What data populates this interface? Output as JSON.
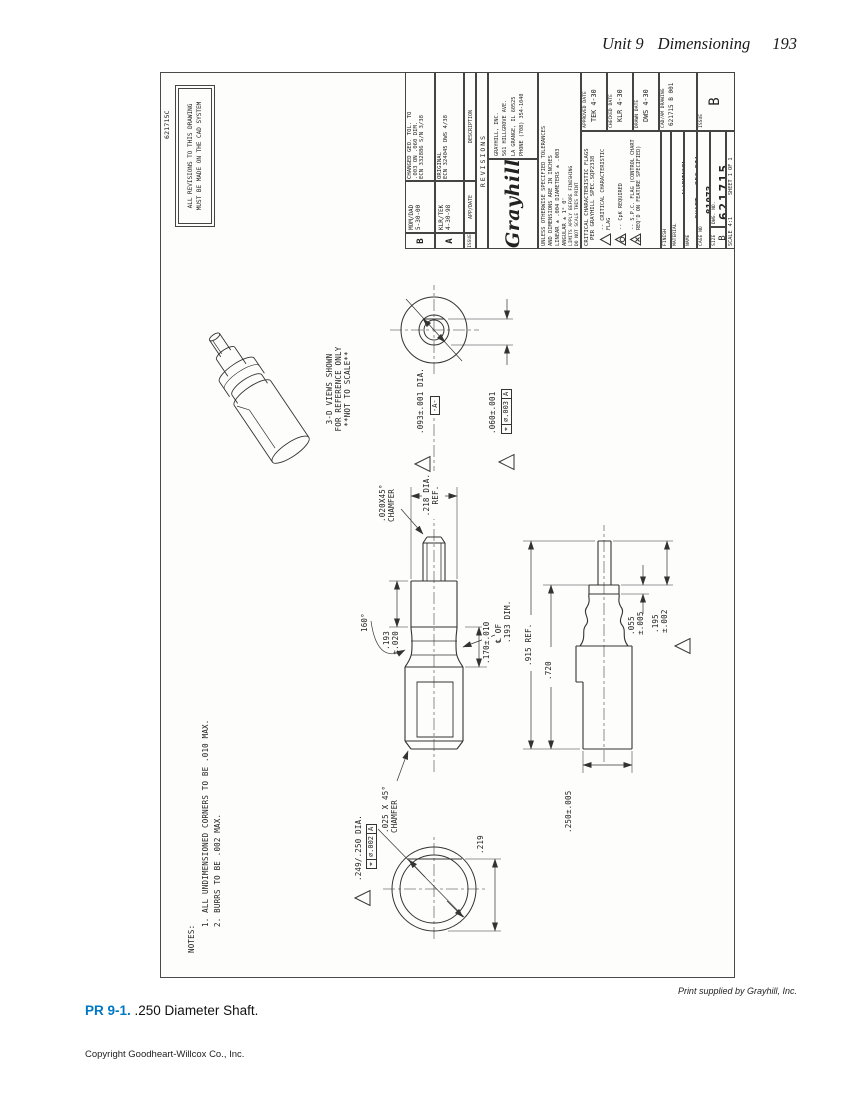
{
  "colors": {
    "accent": "#0077c4",
    "line": "#333333"
  },
  "page": {
    "header": {
      "unit": "Unit 9",
      "title": "Dimensioning",
      "page_number": "193"
    },
    "credit": "Print supplied by Grayhill, Inc.",
    "figure_label": "PR 9-1.",
    "figure_caption": " .250 Diameter Shaft.",
    "footer": "Copyright Goodheart-Willcox Co., Inc."
  },
  "drawing": {
    "labels": {
      "corner_mark": "621715C",
      "cad_note": "ALL REVISIONS TO THIS DRAWING\nMUST BE MADE ON THE CAD SYSTEM",
      "notes_title": "NOTES:",
      "note1": "1.  ALL UNDIMENSIONED CORNERS TO BE .010 MAX.",
      "note2": "2.  BURRS TO BE .002 MAX.",
      "ref_note": "3-D VIEWS SHOWN\nFOR REFERENCE ONLY\n**NOT TO SCALE**",
      "dia249": ".249/.250 DIA.",
      "chamfer025": ".025 X 45°\nCHAMFER",
      "d219": ".219",
      "d915": ".915 REF.",
      "d720": ".720",
      "d250": ".250±.005",
      "d055": ".055\n±.005",
      "d195": ".195\n±.002",
      "d193": ".193\n±.020",
      "a160": "160°",
      "d170": ".170±.010",
      "clnote": "℄ OF\n.193 DIM.",
      "d218": ".218 DIA.\nREF.",
      "chamfer020": ".020X45°\nCHAMFER",
      "dia093": ".093±.001 DIA.",
      "datumA": "-A-",
      "d060": ".060±.001"
    },
    "fcf249": {
      "sym": "⌖",
      "tol": "∅.002",
      "datum": "A"
    },
    "fcf060": {
      "sym": "⌖",
      "tol": "∅.003",
      "datum": "A"
    },
    "title_block": {
      "revisions": {
        "caption": "REVISIONS",
        "col_issue": "ISSUE",
        "col_app": "APP/DATE",
        "col_desc": "DESCRIPTION",
        "rows": [
          {
            "issue": "B",
            "app": "MOM/DAD\n5-30-00",
            "desc": "CHANGED GEO. TOL. TO\n.003 ON .060 DIM.\nECN 332886 S/N 3/38"
          },
          {
            "issue": "A",
            "app": "KLR/TEK\n4-30-98",
            "desc": "ORIGINAL\nECN 324045 DWS 4/38"
          }
        ]
      },
      "company": {
        "logo": "Grayhill",
        "line1": "GRAYHILL, INC.",
        "line2": "561 HILLGROVE AVE.",
        "line3": "LA GRANGE, IL 60525",
        "line4": "PHONE (708) 354-1040"
      },
      "tolerances": {
        "l1": "UNLESS OTHERWISE SPECIFIED TOLERANCES",
        "l2": "AND DIMENSIONS ARE IN INCHES",
        "l3": "LINEAR ± .004  DIAMETERS ± .003",
        "l4": "ANGULAR ± 1° 0'",
        "l5": "LIMITS APPLY BEFORE FINISHING",
        "l6": "DO NOT SCALE THIS PRINT"
      },
      "flags": {
        "title": "CRITICAL CHARACTERISTIC FLAGS",
        "subtitle": "PER GRAYHILL SPEC.SQP2338",
        "f1": "-- CRITICAL CHARACTERISTIC FLAG",
        "f2": "-- CpK REQUIRED",
        "f3": "-- S.P.C. FLAG (CONTROL CHART\nREQ'D ON FEATURE SPECIFIED)"
      },
      "approved": {
        "label": "APPROVED    DATE",
        "value": "TEK    4-30"
      },
      "checked": {
        "label": "CHECKED    DATE",
        "value": "KLR    4-30"
      },
      "drawn": {
        "label": "DRAWN    DATE",
        "value": "DWS    4-30"
      },
      "finish_label": "FINISH",
      "material": {
        "label": "MATERIAL",
        "value": "ALUMINUM"
      },
      "part_name": {
        "label": "NAME",
        "value": "SHAFT, .250 DIA."
      },
      "cage": {
        "label": "CAGE NO",
        "value": "81073"
      },
      "cadam": {
        "label": "CAD/AM DRAWING",
        "value": "621715 B 001"
      },
      "size": {
        "label": "SIZE",
        "value": "B"
      },
      "dwg": {
        "label": "DWG. NO.",
        "value": "621715"
      },
      "issue": {
        "label": "ISSUE",
        "value": "B"
      },
      "scale": {
        "label": "SCALE",
        "value": "4:1"
      },
      "sheet": "SHEET 1  OF 1"
    }
  }
}
